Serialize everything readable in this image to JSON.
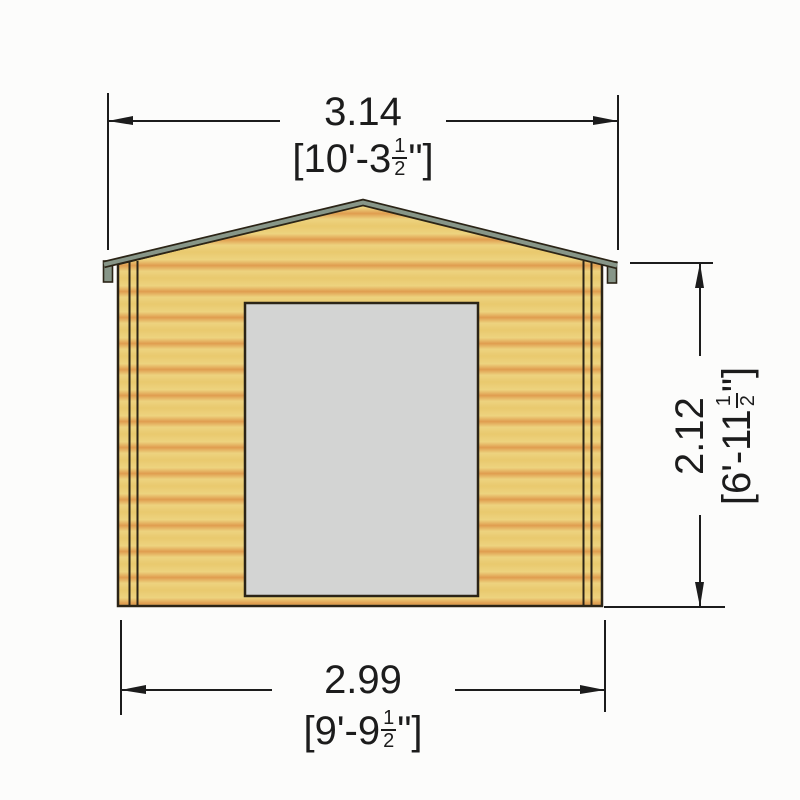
{
  "drawing": {
    "subject": "log-cabin-front-elevation",
    "dimensions": {
      "width_overall": {
        "metric_m": "3.14",
        "imperial_prefix": "[10'-3",
        "fraction_numerator": "1",
        "fraction_denominator": "2",
        "imperial_suffix": "\"]"
      },
      "width_base": {
        "metric_m": "2.99",
        "imperial_prefix": "[9'-9",
        "fraction_numerator": "1",
        "fraction_denominator": "2",
        "imperial_suffix": "\"]"
      },
      "height_eaves": {
        "metric_m": "2.12",
        "imperial_prefix": "[6'-11",
        "fraction_numerator": "1",
        "fraction_denominator": "2",
        "imperial_suffix": "\"]"
      }
    }
  },
  "colors": {
    "wood_light": "#e9c96e",
    "wood_lighter": "#edd37f",
    "wood_dark": "#e09d4f",
    "roof_trim": "#879688",
    "door_fill": "#d3d4d3",
    "outline": "#2b2416",
    "dim_color": "#1c1c1c",
    "background": "#fcfcfb"
  }
}
